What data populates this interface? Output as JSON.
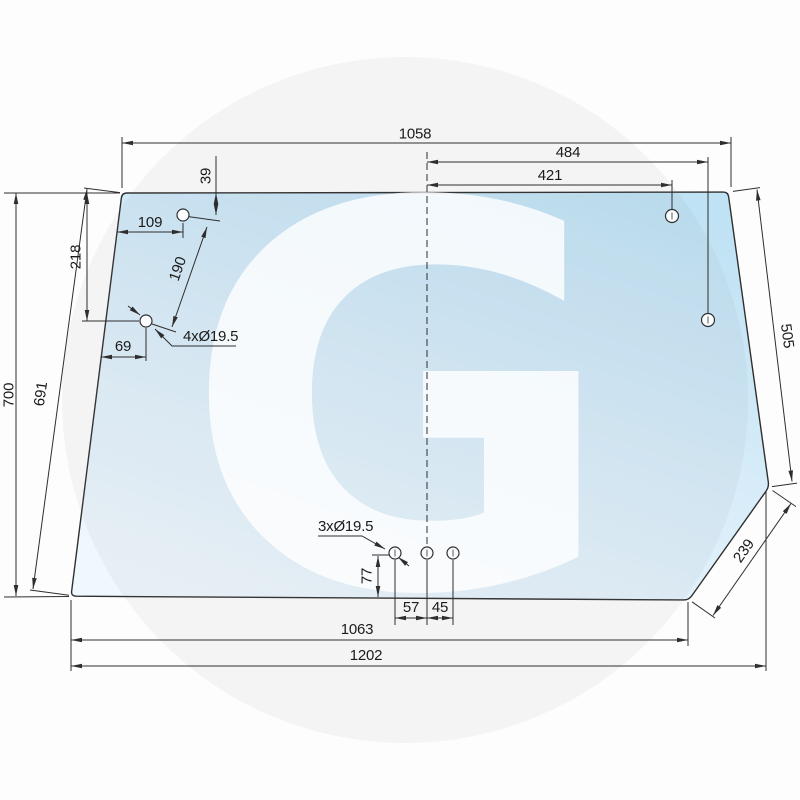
{
  "dimensions": {
    "top_overall": "1058",
    "right_holes_span_outer": "484",
    "right_holes_span_inner": "421",
    "upper_left_hole_from_top": "39",
    "upper_left_hole_from_edge": "109",
    "left_holes_vertical_offset": "218",
    "left_holes_distance": "190",
    "lower_left_hole_from_edge": "69",
    "left_edge_length": "691",
    "overall_height": "700",
    "right_edge_length": "505",
    "corner_chamfer_length": "239",
    "bottom_holes_height": "77",
    "bottom_holes_spacing_left": "57",
    "bottom_holes_spacing_right": "45",
    "bottom_inner_width": "1063",
    "bottom_overall_width": "1202",
    "upper_left_holes_label": "4xØ19.5",
    "bottom_holes_label": "3xØ19.5"
  },
  "watermark": {
    "letter": "G"
  },
  "colors": {
    "glass_top": "#bfe2f4",
    "glass_mid": "#d9edf9",
    "glass_bottom": "#eff8fd",
    "line": "#2e2e2e",
    "background": "#fdfdfd",
    "watermark_disc": "rgba(130,140,150,0.075)",
    "watermark_letter": "rgba(255,255,255,0.8)"
  }
}
